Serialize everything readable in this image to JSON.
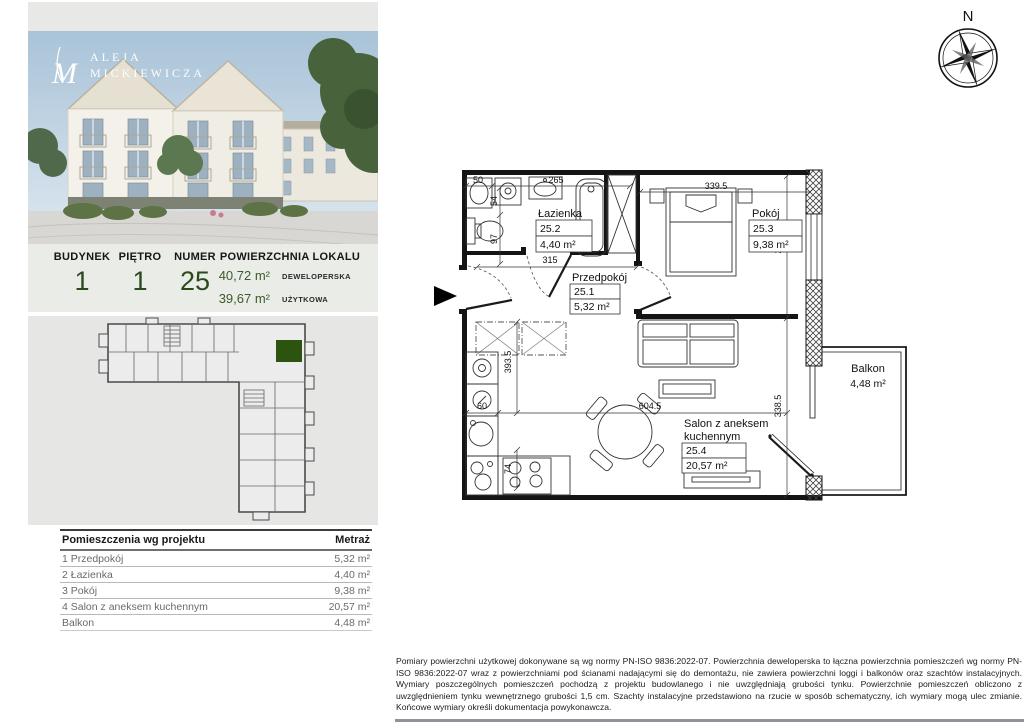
{
  "logo": {
    "monogram": "M",
    "line1": "ALEJA",
    "line2": "MICKIEWICZA"
  },
  "info": {
    "headers": {
      "building": "BUDYNEK",
      "floor": "PIĘTRO",
      "number": "NUMER",
      "area": "POWIERZCHNIA LOKALU"
    },
    "building": "1",
    "floor": "1",
    "number": "25",
    "area_developer": {
      "value": "40,72 m²",
      "label": "DEWELOPERSKA"
    },
    "area_usable": {
      "value": "39,67 m²",
      "label": "UŻYTKOWA"
    }
  },
  "rooms_table": {
    "title": "Pomieszczenia wg projektu",
    "area_header": "Metraż",
    "rows": [
      {
        "name": "1 Przedpokój",
        "area": "5,32 m²"
      },
      {
        "name": "2 Łazienka",
        "area": "4,40 m²"
      },
      {
        "name": "3 Pokój",
        "area": "9,38 m²"
      },
      {
        "name": "4 Salon z aneksem kuchennym",
        "area": "20,57 m²"
      },
      {
        "name": "Balkon",
        "area": "4,48 m²"
      }
    ]
  },
  "plan": {
    "rooms": {
      "lazienka": {
        "name": "Łazienka",
        "no": "25.2",
        "area": "4,40 m²"
      },
      "przedpokoj": {
        "name": "Przedpokój",
        "no": "25.1",
        "area": "5,32 m²"
      },
      "pokoj": {
        "name": "Pokój",
        "no": "25.3",
        "area": "9,38 m²"
      },
      "salon": {
        "name": "Salon z aneksem",
        "name2": "kuchennym",
        "no": "25.4",
        "area": "20,57 m²"
      },
      "balkon": {
        "name": "Balkon",
        "area": "4,48 m²"
      }
    },
    "dims": {
      "w50": "50",
      "w265": "265",
      "w339": "339.5",
      "h54": "54",
      "h97": "97",
      "w315": "315",
      "h280": "280",
      "h393": "393.5",
      "w60": "60",
      "w604": "604.5",
      "h74": "74",
      "h338": "338.5"
    }
  },
  "compass": {
    "north": "N"
  },
  "colors": {
    "accent_green": "#2c4a1c",
    "unit_green": "#2c5310",
    "panel_gray": "#eaece8"
  },
  "footer": {
    "disclaimer": "Pomiary powierzchni użytkowej dokonywane są wg normy PN-ISO 9836:2022-07. Powierzchnia deweloperska to łączna powierzchnia pomieszczeń wg normy PN-ISO 9836:2022-07 wraz z powierzchniami pod ścianami nadającymi się do demontażu, nie zawiera powierzchni loggi i balkonów oraz szachtów instalacyjnych. Wymiary poszczególnych pomieszczeń pochodzą z projektu budowlanego i nie uwzględniają grubości tynku. Powierzchnie  pomieszczeń obliczono z uwzględnieniem tynku wewnętrznego grubości 1,5 cm. Szachty instalacyjne przedstawiono na rzucie w sposób schematyczny, ich wymiary mogą ulec zmianie. Końcowe wymiary określi dokumentacja powykonawcza."
  }
}
